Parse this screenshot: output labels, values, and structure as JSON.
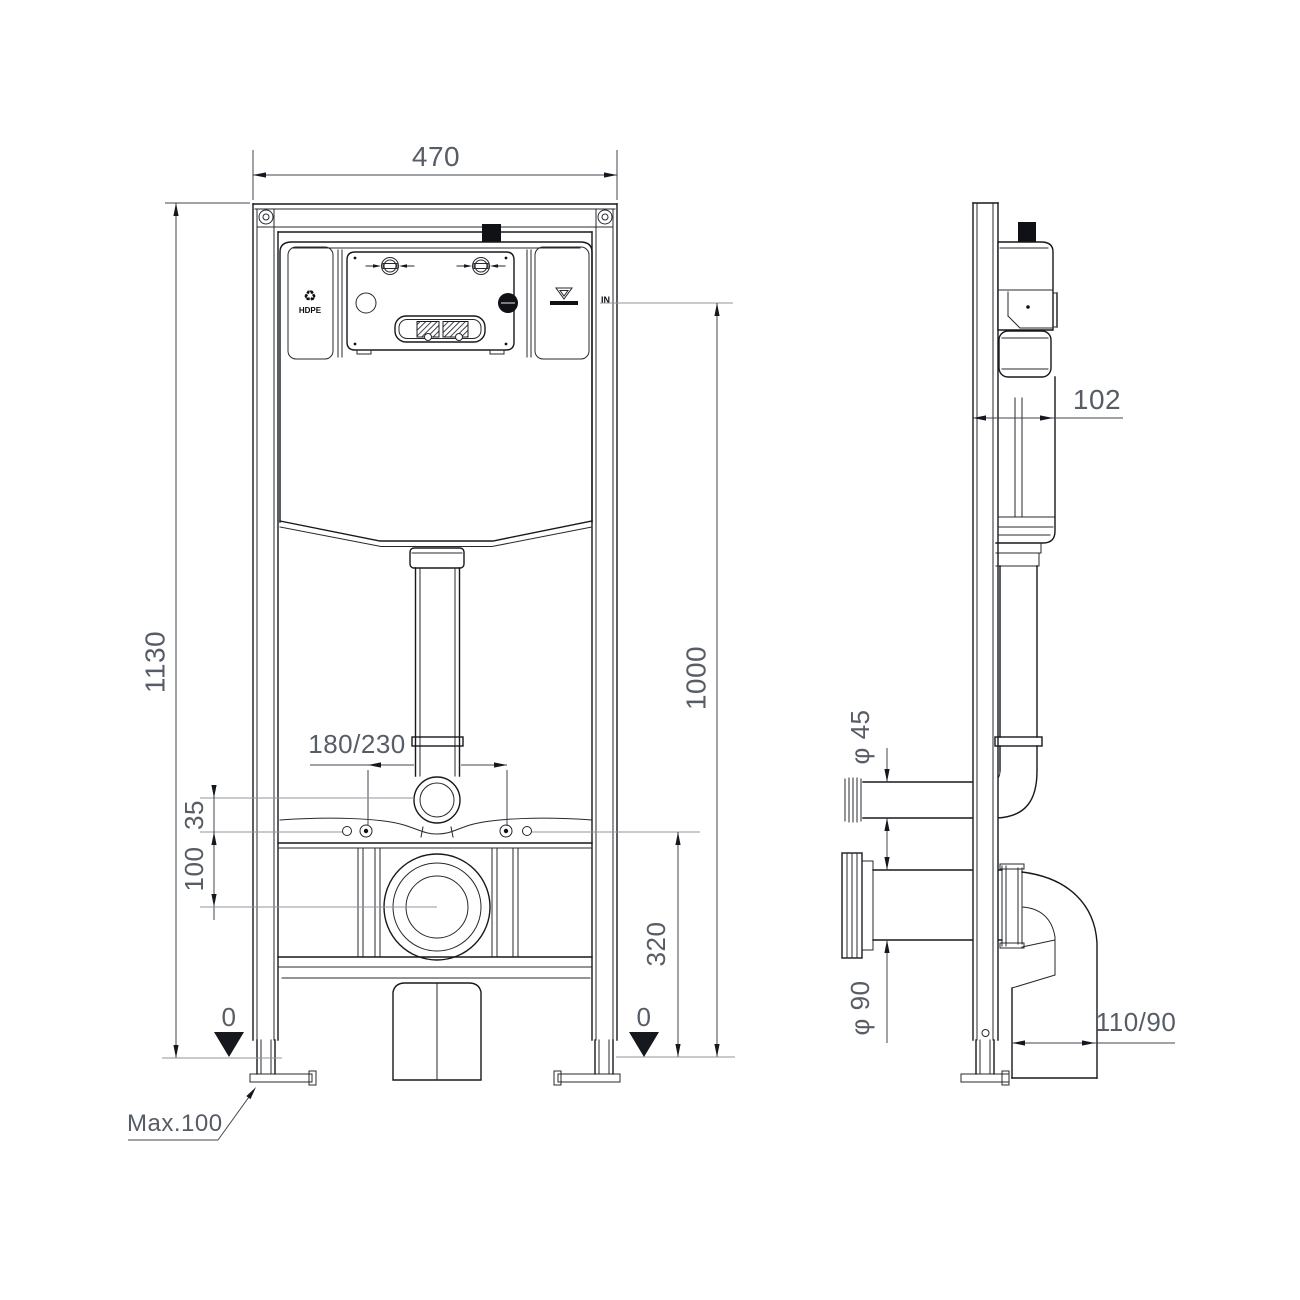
{
  "front": {
    "width": "470",
    "height": "1130",
    "water_height": "1000",
    "bolt_spacing": "180/230",
    "flush_offset": "35",
    "waste_offset": "100",
    "bolt_height": "320",
    "datum_left": "0",
    "datum_right": "0",
    "foot_adjust": "Max.100",
    "material": "HDPE",
    "inlet": "IN"
  },
  "side": {
    "depth": "102",
    "flush_dia": "φ 45",
    "waste_dia": "φ 90",
    "outlet": "110/90"
  },
  "icons": {
    "recycle": "♻"
  },
  "colors": {
    "line": "#16181c",
    "dimension_text": "#575d66",
    "background": "#ffffff"
  }
}
